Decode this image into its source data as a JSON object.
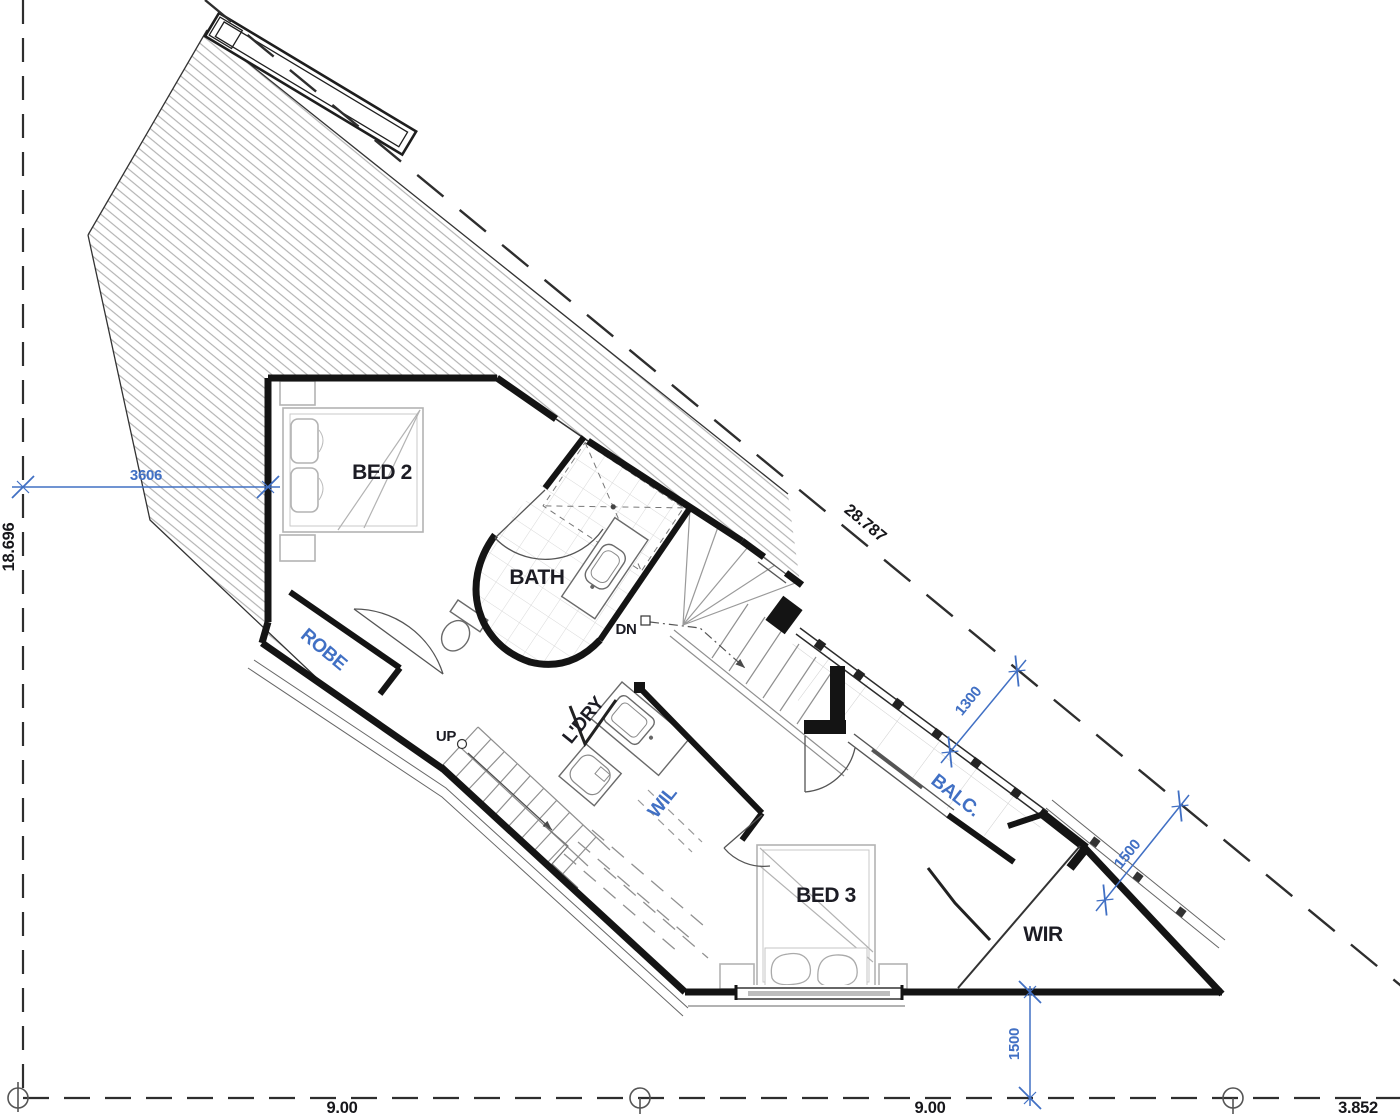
{
  "drawing": {
    "rooms": {
      "bed2": "BED 2",
      "bath": "BATH",
      "robe": "ROBE",
      "laundry": "L'DRY",
      "linen": "WIL",
      "bed3": "BED 3",
      "wardrobe": "WIR",
      "balcony": "BALC."
    },
    "stairs": {
      "down": "DN",
      "up": "UP"
    },
    "internal_dimensions_mm": {
      "bed2_width": "3606",
      "balcony_width": "1300",
      "setback_upper": "1500",
      "setback_lower": "1500"
    },
    "boundary_dimensions_m": {
      "west": "18.696",
      "north_east": "28.787",
      "south_1": "9.00",
      "south_2": "9.00",
      "south_3": "3.852"
    },
    "colors": {
      "dimension_blue": "#4170c4",
      "line_black": "#141414"
    }
  }
}
